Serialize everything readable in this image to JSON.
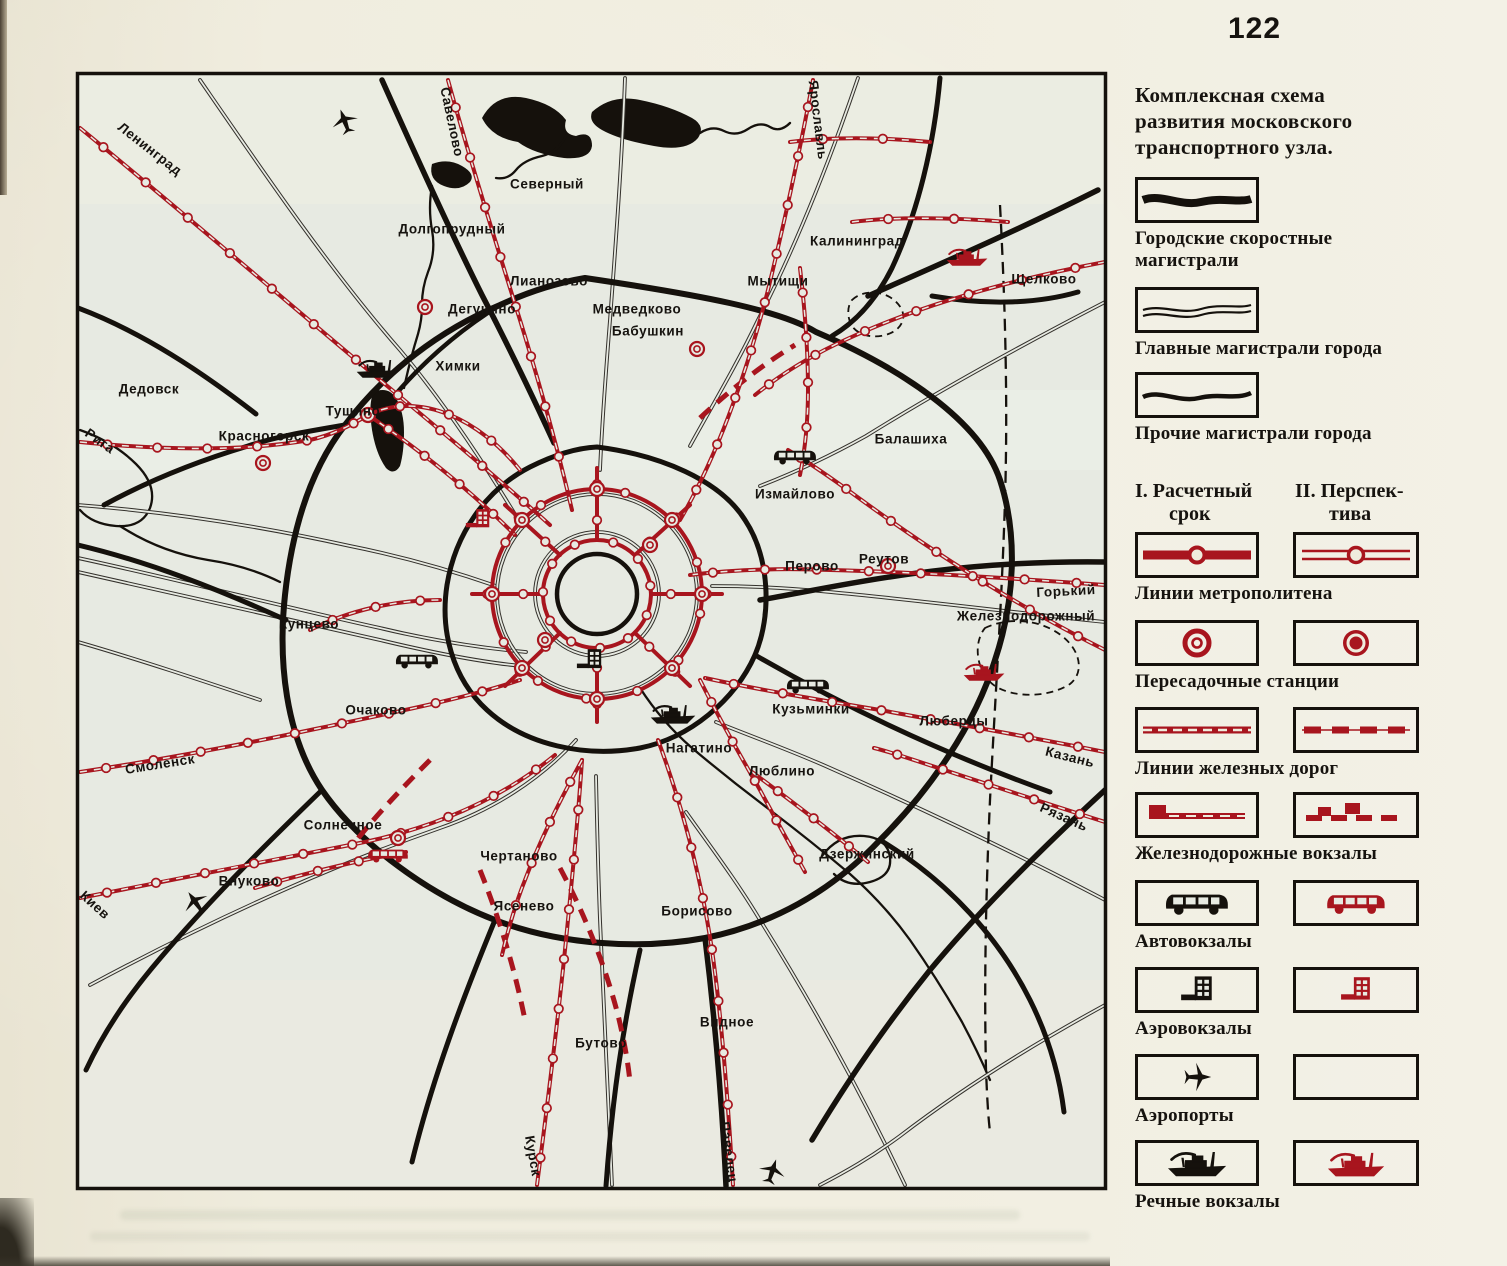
{
  "page_number": "122",
  "colors": {
    "red": "#a8151e",
    "black": "#15110c",
    "paper": "#efecdd",
    "map_bg": "#e7eae2"
  },
  "legend": {
    "title_lines": [
      "Комплексная схема",
      "развития московского",
      "транспортного узла."
    ],
    "road_items": [
      {
        "label": "Городские скоростные магистрали",
        "icon": "express-road-swatch"
      },
      {
        "label": "Главные магистрали города",
        "icon": "main-road-swatch"
      },
      {
        "label": "Прочие магистрали города",
        "icon": "other-road-swatch"
      }
    ],
    "columns": {
      "i": {
        "l1": "I. Расчетный",
        "l2": "срок"
      },
      "ii": {
        "l1": "II. Перспек-",
        "l2": "тива"
      }
    },
    "paired_items": [
      {
        "label": "Линии метрополитена"
      },
      {
        "label": "Пересадочные станции"
      },
      {
        "label": "Линии железных дорог"
      },
      {
        "label": "Железнодорожные вокзалы"
      },
      {
        "label": "Автовокзалы"
      },
      {
        "label": "Аэровокзалы"
      },
      {
        "label": "Аэропорты"
      },
      {
        "label": "Речные вокзалы"
      }
    ]
  },
  "map": {
    "labels": [
      {
        "t": "Ленинград",
        "x": 150,
        "y": 149,
        "r": 38
      },
      {
        "t": "Савелово",
        "x": 452,
        "y": 122,
        "r": 78
      },
      {
        "t": "Северный",
        "x": 547,
        "y": 184,
        "r": 0
      },
      {
        "t": "Ярославль",
        "x": 818,
        "y": 120,
        "r": 83
      },
      {
        "t": "Долгопрудный",
        "x": 452,
        "y": 229,
        "r": 0
      },
      {
        "t": "Калининград",
        "x": 857,
        "y": 241,
        "r": 0
      },
      {
        "t": "Лианозово",
        "x": 549,
        "y": 281,
        "r": 0
      },
      {
        "t": "Мытищи",
        "x": 778,
        "y": 281,
        "r": 0
      },
      {
        "t": "Щелково",
        "x": 1044,
        "y": 279,
        "r": 0
      },
      {
        "t": "Дегунино",
        "x": 482,
        "y": 309,
        "r": 0
      },
      {
        "t": "Медведково",
        "x": 637,
        "y": 309,
        "r": 0
      },
      {
        "t": "Бабушкин",
        "x": 648,
        "y": 331,
        "r": 0
      },
      {
        "t": "Химки",
        "x": 458,
        "y": 366,
        "r": 0
      },
      {
        "t": "Дедовск",
        "x": 149,
        "y": 389,
        "r": 0
      },
      {
        "t": "Тушино",
        "x": 353,
        "y": 411,
        "r": 0
      },
      {
        "t": "Красногорск",
        "x": 264,
        "y": 436,
        "r": 0
      },
      {
        "t": "Рига",
        "x": 100,
        "y": 441,
        "r": 35
      },
      {
        "t": "Балашиха",
        "x": 911,
        "y": 439,
        "r": 0
      },
      {
        "t": "Измайлово",
        "x": 795,
        "y": 494,
        "r": 0
      },
      {
        "t": "Реутов",
        "x": 884,
        "y": 559,
        "r": 0
      },
      {
        "t": "Перово",
        "x": 812,
        "y": 566,
        "r": 0
      },
      {
        "t": "Горький",
        "x": 1066,
        "y": 591,
        "r": -3
      },
      {
        "t": "Железнодорожный",
        "x": 1026,
        "y": 616,
        "r": 0
      },
      {
        "t": "Кунцево",
        "x": 309,
        "y": 624,
        "r": 0
      },
      {
        "t": "Очаково",
        "x": 376,
        "y": 710,
        "r": 0
      },
      {
        "t": "Кузьминки",
        "x": 811,
        "y": 709,
        "r": 0
      },
      {
        "t": "Люберцы",
        "x": 954,
        "y": 721,
        "r": 0
      },
      {
        "t": "Нагатино",
        "x": 699,
        "y": 748,
        "r": 0
      },
      {
        "t": "Казань",
        "x": 1070,
        "y": 757,
        "r": 14
      },
      {
        "t": "Смоленск",
        "x": 160,
        "y": 764,
        "r": -9
      },
      {
        "t": "Люблино",
        "x": 782,
        "y": 771,
        "r": 0
      },
      {
        "t": "Рязань",
        "x": 1064,
        "y": 817,
        "r": 24
      },
      {
        "t": "Солнечное",
        "x": 343,
        "y": 825,
        "r": 0
      },
      {
        "t": "Чертаново",
        "x": 519,
        "y": 856,
        "r": 0
      },
      {
        "t": "Дзержинский",
        "x": 867,
        "y": 854,
        "r": 0
      },
      {
        "t": "Внуково",
        "x": 249,
        "y": 881,
        "r": 0
      },
      {
        "t": "Киев",
        "x": 95,
        "y": 905,
        "r": 42
      },
      {
        "t": "Ясенево",
        "x": 524,
        "y": 906,
        "r": 0
      },
      {
        "t": "Борисово",
        "x": 697,
        "y": 911,
        "r": 0
      },
      {
        "t": "Видное",
        "x": 727,
        "y": 1022,
        "r": 0
      },
      {
        "t": "Бутово",
        "x": 601,
        "y": 1043,
        "r": 0
      },
      {
        "t": "Курск",
        "x": 533,
        "y": 1156,
        "r": 80
      },
      {
        "t": "Павелец",
        "x": 729,
        "y": 1152,
        "r": 82
      }
    ]
  }
}
